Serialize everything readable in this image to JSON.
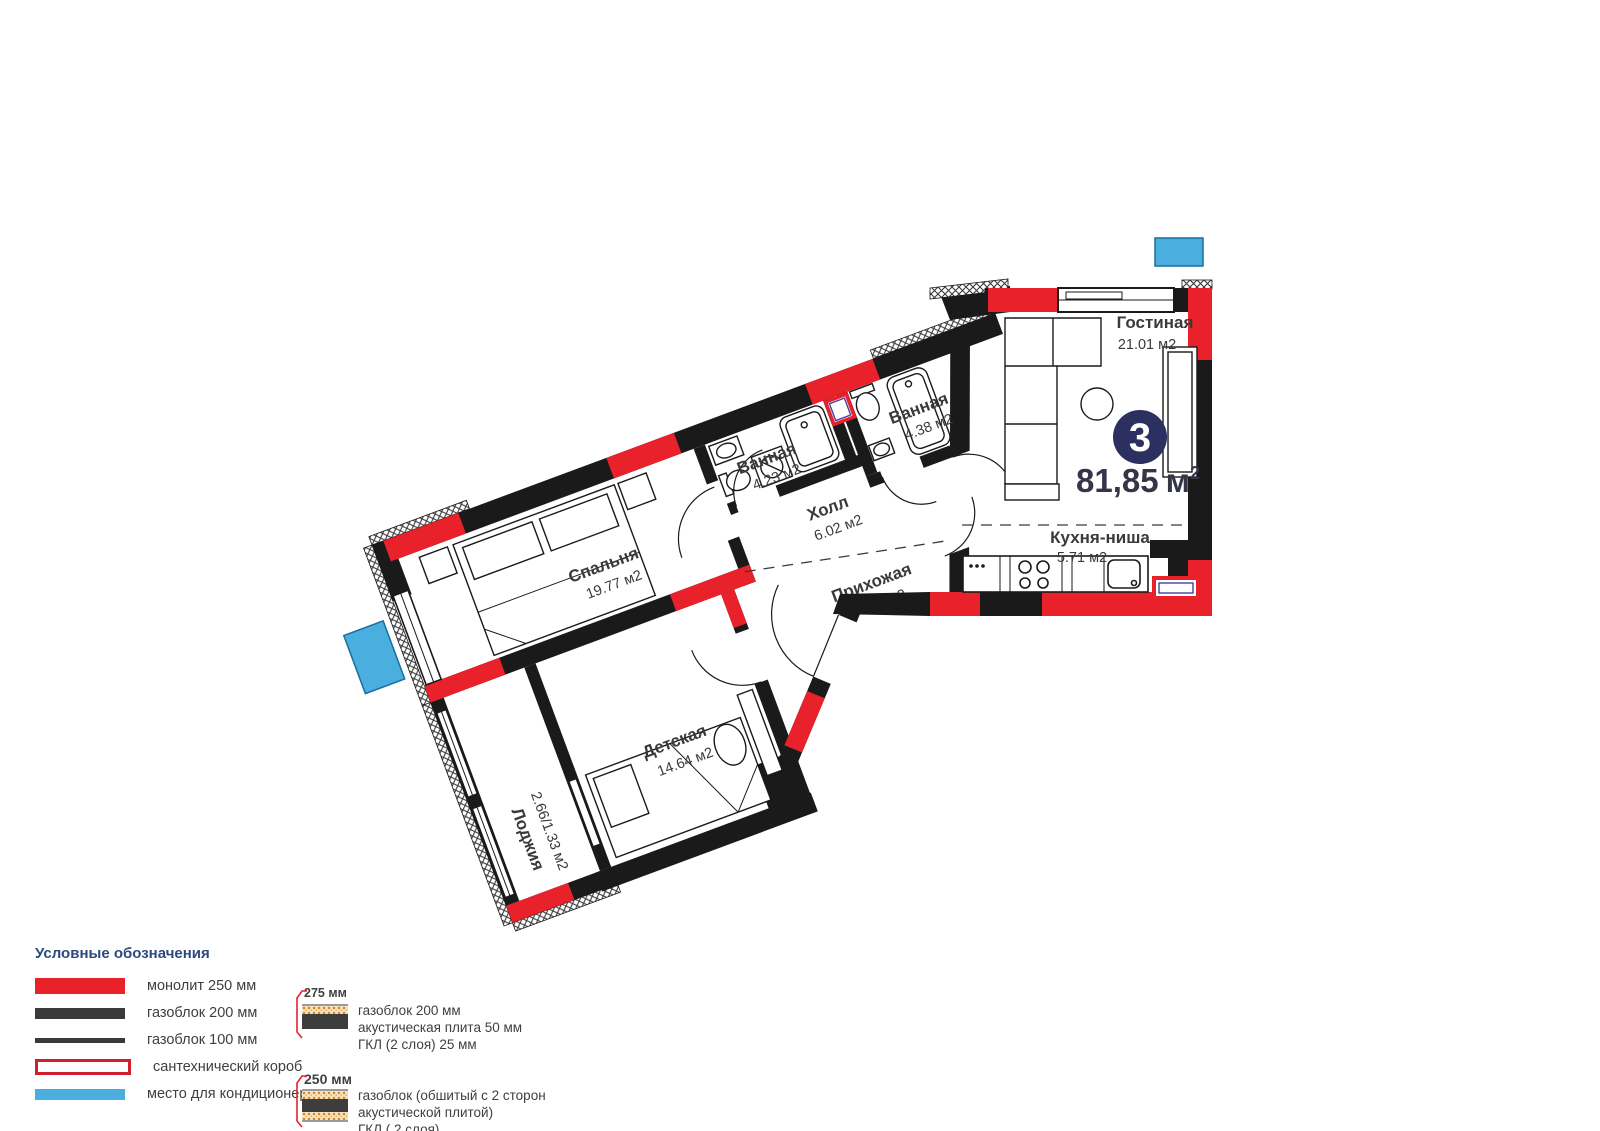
{
  "plan": {
    "unit_badge": "3",
    "total_area": "81,85",
    "total_area_unit": "м",
    "total_area_exponent": "2",
    "rooms": {
      "living": {
        "name": "Гостиная",
        "area": "21.01 м2"
      },
      "bath1": {
        "name": "Ванная",
        "area": "4.38 м2"
      },
      "bath2": {
        "name": "Ванная",
        "area": "4.23 м2"
      },
      "hall": {
        "name": "Холл",
        "area": "6.02 м2"
      },
      "bedroom": {
        "name": "Спальня",
        "area": "19.77 м2"
      },
      "entry": {
        "name": "Прихожая",
        "area": "4.77 м2"
      },
      "kitchen": {
        "name": "Кухня-ниша",
        "area": "5.71 м2"
      },
      "kids": {
        "name": "Детская",
        "area": "14.64 м2"
      },
      "loggia": {
        "name": "Лоджия",
        "area": "2.66/1.33 м2"
      }
    }
  },
  "legend": {
    "title": "Условные обозначения",
    "items": [
      {
        "id": "monolith",
        "label": "монолит 250 мм"
      },
      {
        "id": "gasblock-200",
        "label": "газоблок 200 мм"
      },
      {
        "id": "gasblock-100",
        "label": "газоблок 100 мм"
      },
      {
        "id": "plumbing-box",
        "label": "сантехнический короб"
      },
      {
        "id": "ac-place",
        "label": "место для кондиционера"
      }
    ],
    "wall_types": [
      {
        "dimension": "275 мм",
        "line1": "газоблок 200 мм",
        "line2": "акустическая плита 50 мм",
        "line3": "ГКЛ (2 слоя) 25 мм"
      },
      {
        "dimension": "250 мм",
        "line1": "газоблок (обшитый с 2 сторон",
        "line2": "акустической плитой)",
        "line3": "ГКЛ ( 2 слоя)"
      }
    ]
  },
  "colors": {
    "monolith": "#e8212b",
    "wall": "#1a1a1a",
    "ac": "#4aaede",
    "badge": "#2b3060",
    "legend_title": "#2c4a7b",
    "text": "#3f3f3f"
  }
}
